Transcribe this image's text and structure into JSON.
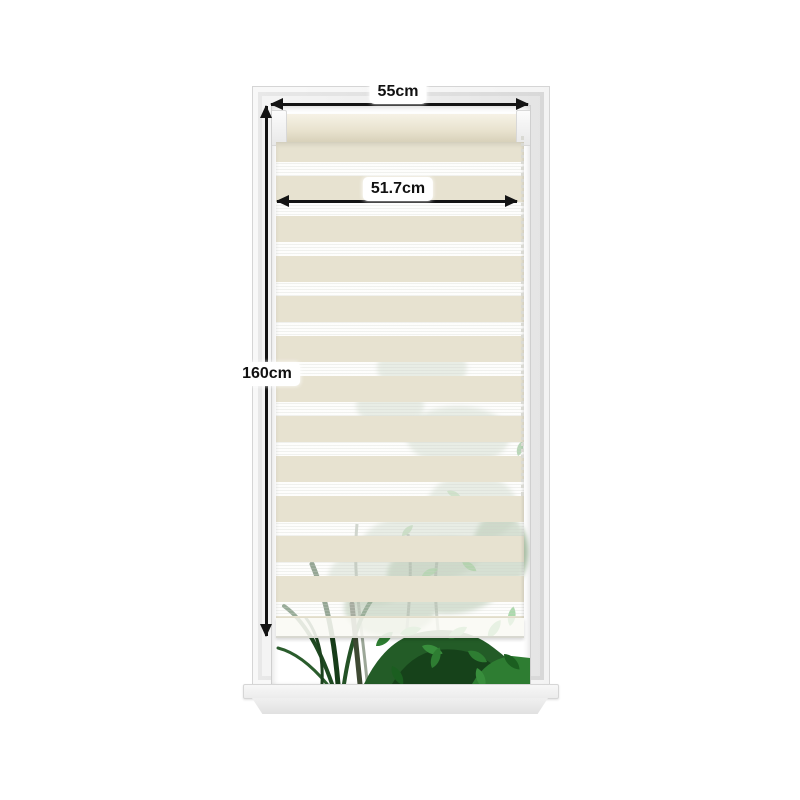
{
  "annotations": {
    "outer_width": {
      "label": "55cm"
    },
    "fabric_width": {
      "label": "51.7cm"
    },
    "height": {
      "label": "160cm"
    }
  },
  "colors": {
    "background": "#ffffff",
    "frame-face": "#ededed",
    "frame-edge": "#d5d5d5",
    "fabric-cream": "#e7e2d0",
    "sheer-white": "#fafaf7",
    "rail-white": "#faf9f4",
    "sill-white": "#f7f7f7",
    "annotation-line": "#141414",
    "label-bg": "#ffffff",
    "label-text": "#111111",
    "plant-dark": "#1b5e20",
    "plant-mid": "#2e7d32",
    "plant-light": "#4caf50"
  }
}
